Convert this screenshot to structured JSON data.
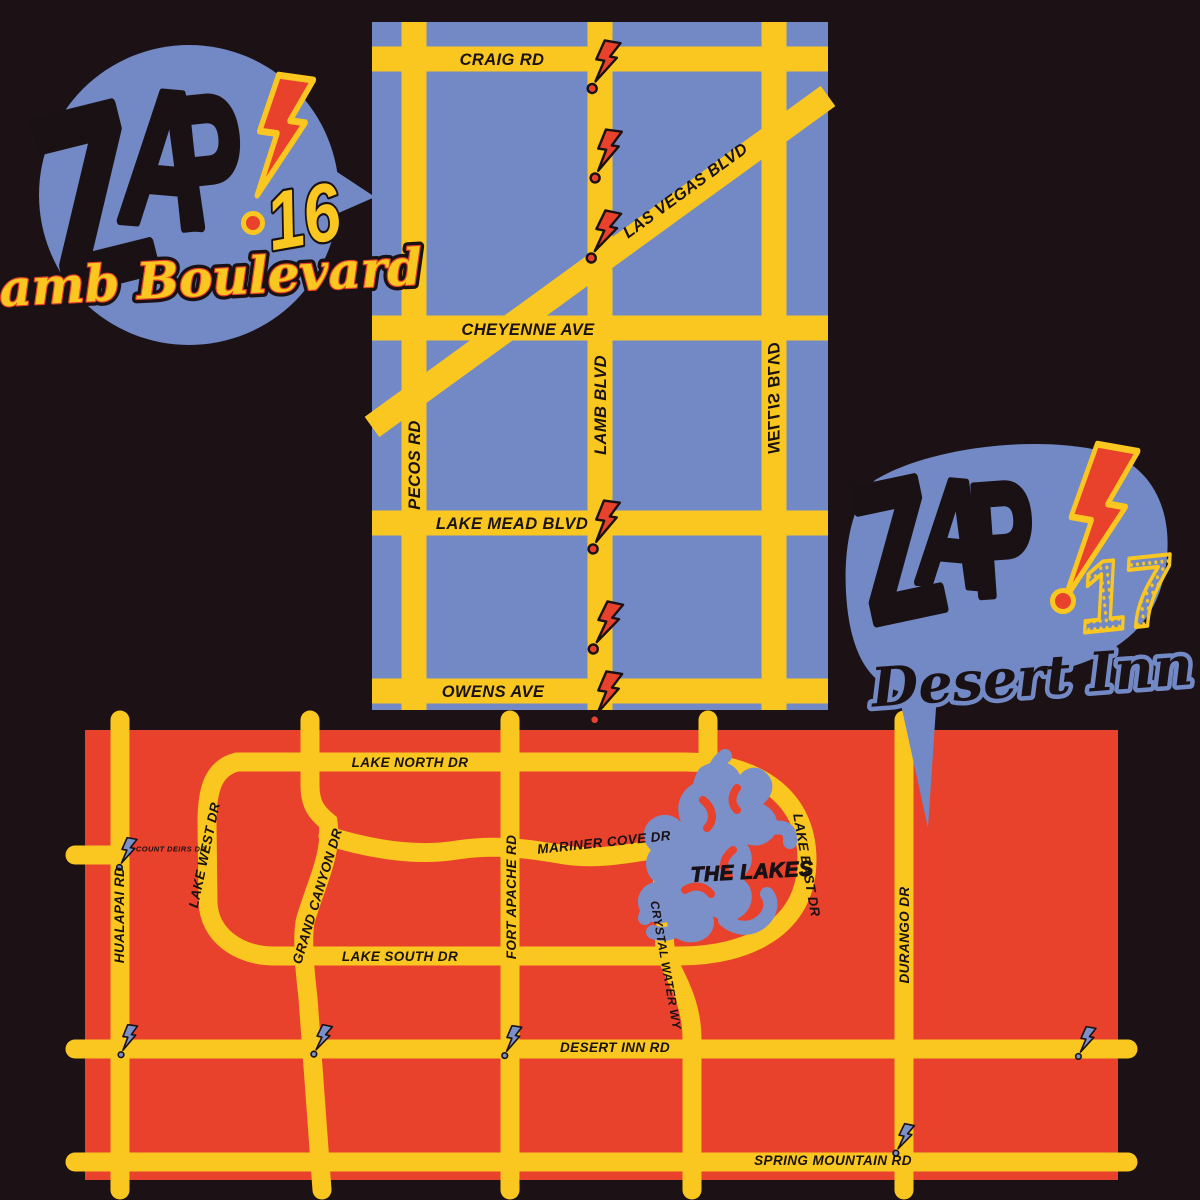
{
  "colors": {
    "background": "#1c1216",
    "map_blue": "#7289c5",
    "road_yellow": "#f9c71f",
    "map_red": "#e8412c",
    "ink_black": "#191114",
    "bolt_red": "#e8412c",
    "bolt_blue": "#7b90c9"
  },
  "logo_zap16": {
    "zap": [
      "Z",
      "A",
      "P"
    ],
    "number": "16",
    "subtitle": "Lamb Boulevard"
  },
  "logo_zap17": {
    "zap": [
      "Z",
      "A",
      "P"
    ],
    "number": "17",
    "subtitle": "Desert Inn"
  },
  "map_lamb_boulevard": {
    "bolt_count": 6,
    "streets": {
      "craig": "CRAIG RD",
      "las_vegas": "LAS VEGAS BLVD",
      "cheyenne": "CHEYENNE AVE",
      "lake_mead": "LAKE MEAD BLVD",
      "owens": "OWENS AVE",
      "pecos": "PECOS RD",
      "lamb": "LAMB BLVD",
      "nellis": "NELLIS BLVD"
    }
  },
  "map_desert_inn": {
    "bolt_count": 6,
    "poi": {
      "the_lakes": "THE LAKES"
    },
    "streets": {
      "lake_north": "LAKE NORTH DR",
      "count_deirs": "COUNT DEIRS DR",
      "lake_west": "LAKE WEST DR",
      "grand_canyon": "GRAND CANYON DR",
      "hualapai": "HUALAPAI RD",
      "lake_south": "LAKE SOUTH DR",
      "mariner_cove": "MARINER COVE DR",
      "fort_apache": "FORT APACHE RD",
      "crystal_water": "CRYSTAL WATER WY",
      "lake_east": "LAKE EAST DR",
      "desert_inn": "DESERT INN RD",
      "durango": "DURANGO DR",
      "spring_mountain": "SPRING MOUNTAIN RD"
    }
  }
}
